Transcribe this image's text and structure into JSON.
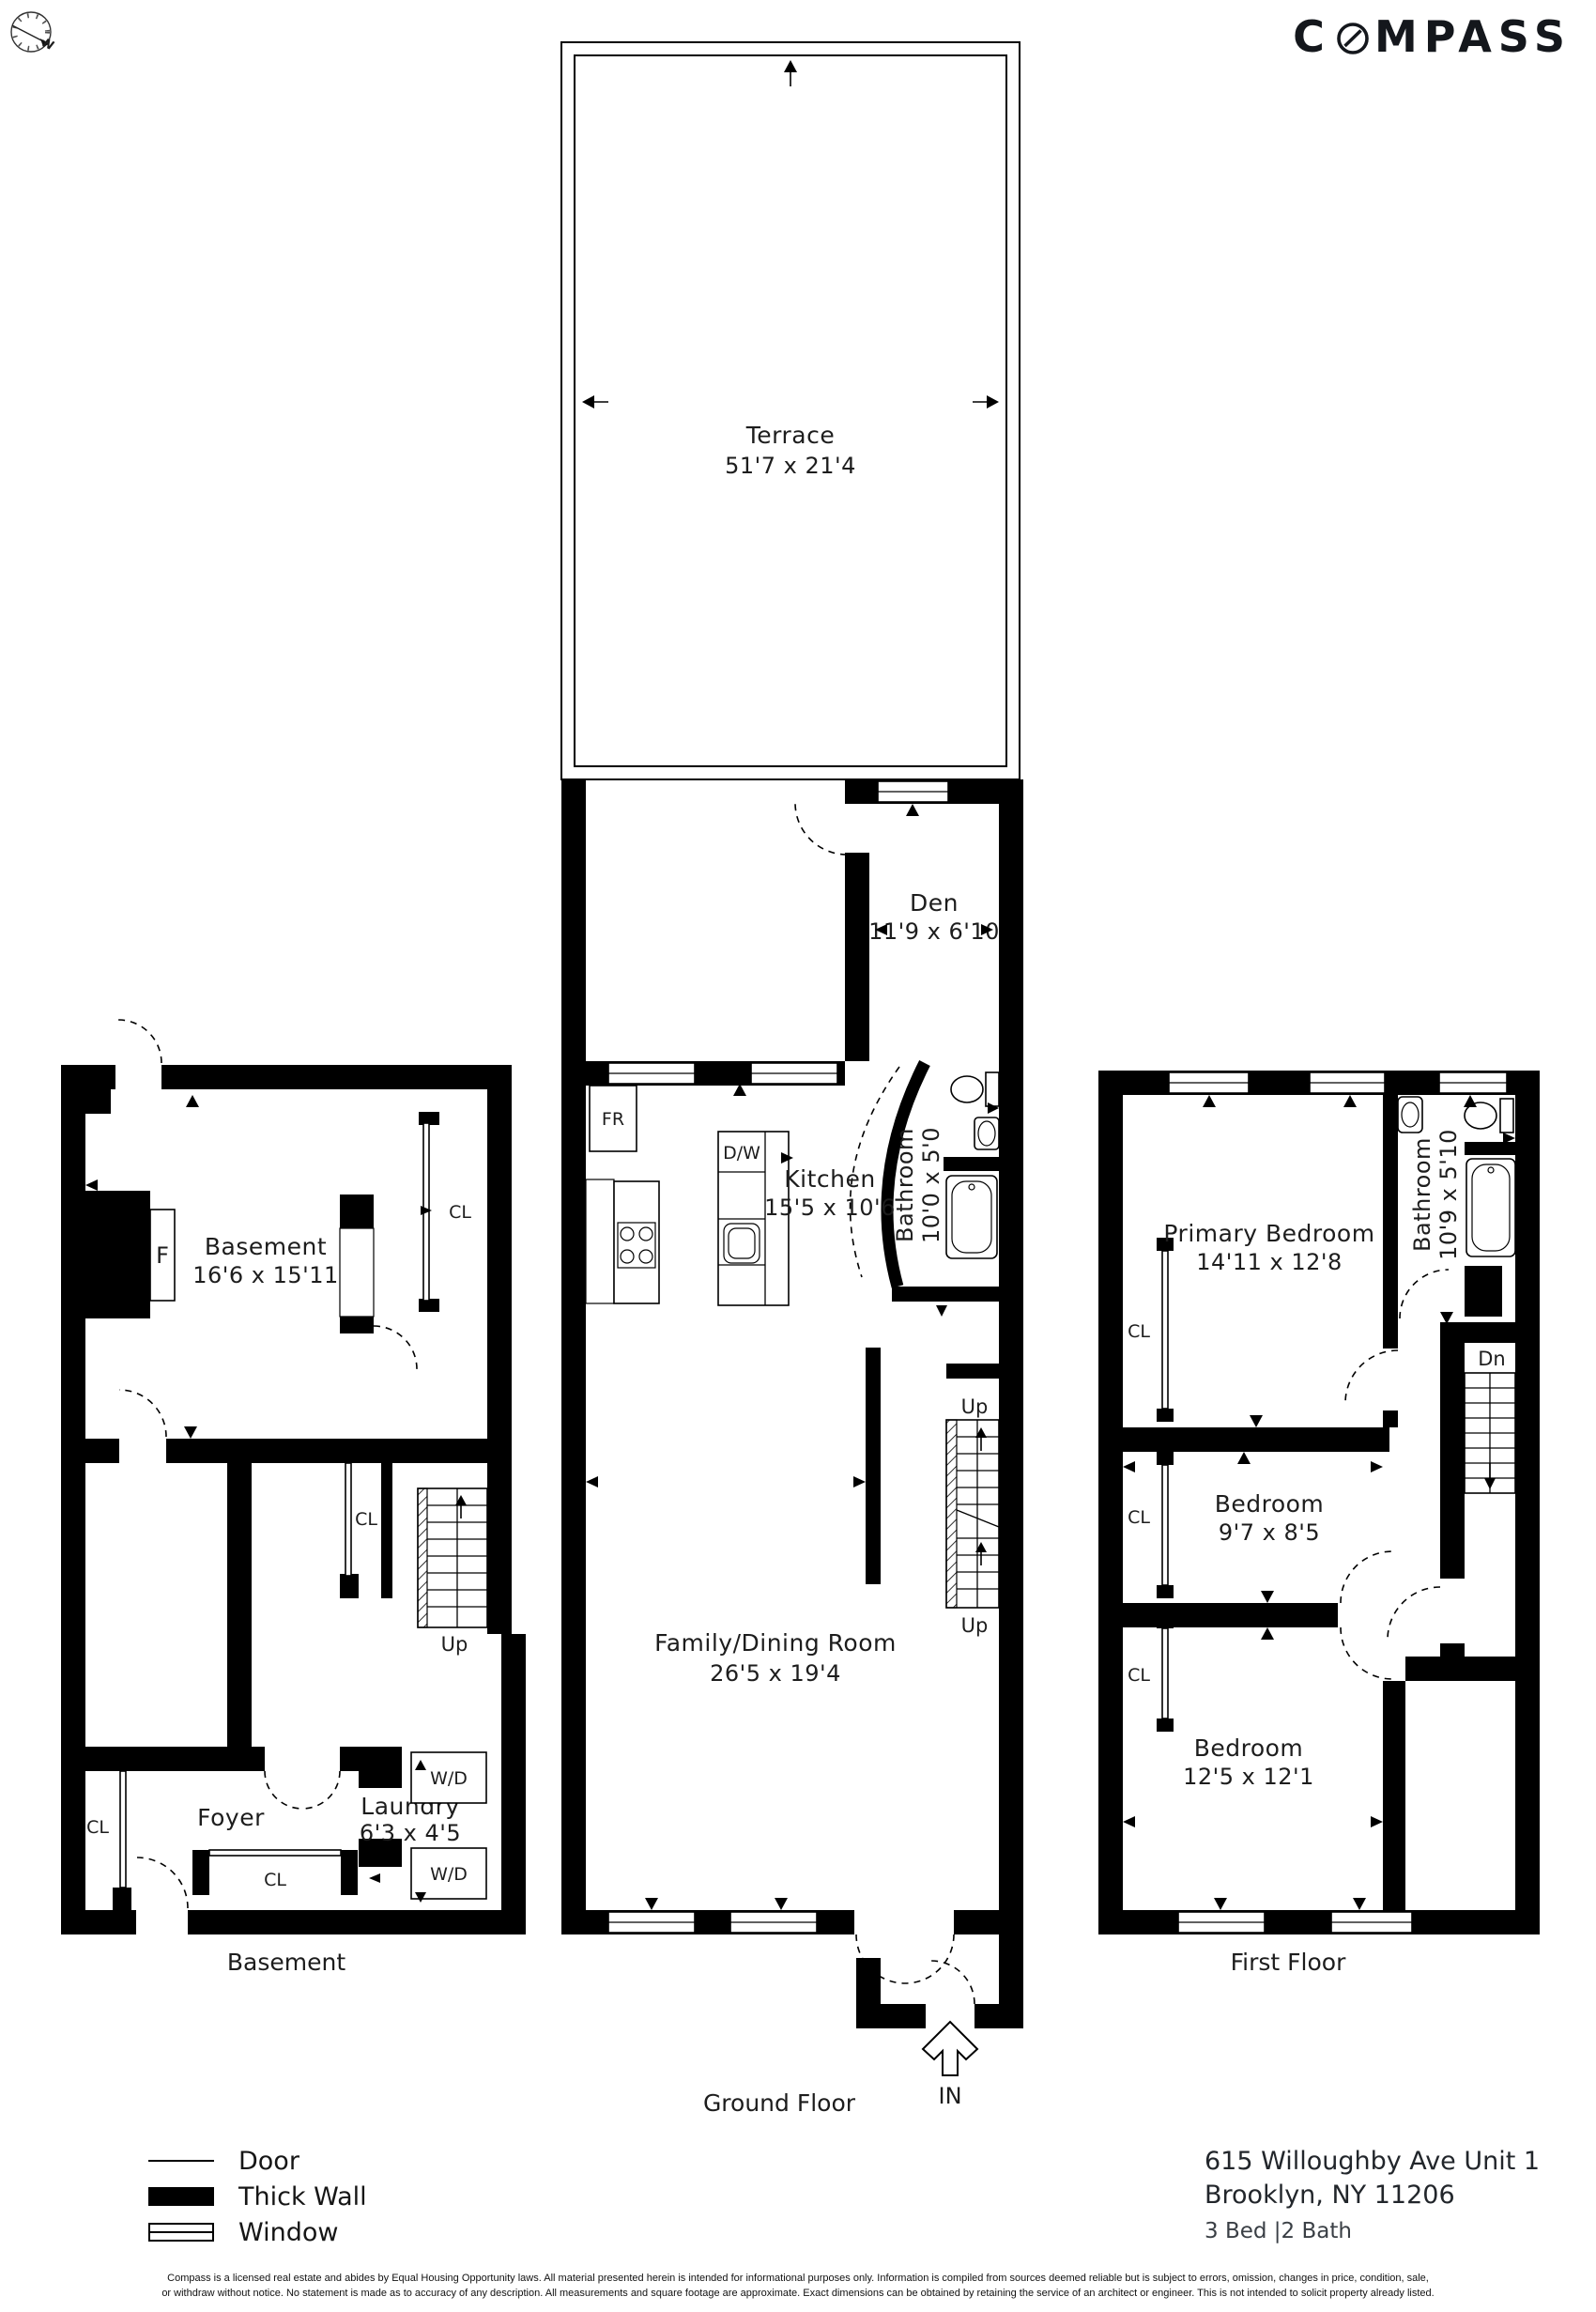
{
  "brand": {
    "logo_c": "C",
    "logo_rest": "MPASS",
    "north": "N"
  },
  "floors": {
    "basement": {
      "title": "Basement",
      "room": {
        "name": "Basement",
        "dims": "16'6 x 15'11"
      },
      "foyer": "Foyer",
      "laundry": {
        "name": "Laundry",
        "dims": "6'3 x 4'5"
      },
      "fireplace": "F",
      "closet_label": "CL",
      "wd_label": "W/D",
      "up": "Up"
    },
    "ground": {
      "title": "Ground Floor",
      "terrace": {
        "name": "Terrace",
        "dims": "51'7 x 21'4"
      },
      "den": {
        "name": "Den",
        "dims": "11'9 x 6'10"
      },
      "kitchen": {
        "name": "Kitchen",
        "dims": "15'5 x 10'6"
      },
      "bathroom": {
        "name": "Bathroom",
        "dims": "10'0 x 5'0"
      },
      "family": {
        "name": "Family/Dining Room",
        "dims": "26'5 x 19'4"
      },
      "fridge": "FR",
      "dishwasher": "D/W",
      "up": "Up",
      "entry": "IN"
    },
    "first": {
      "title": "First Floor",
      "primary": {
        "name": "Primary Bedroom",
        "dims": "14'11 x 12'8"
      },
      "bathroom": {
        "name": "Bathroom",
        "dims": "10'9 x 5'10"
      },
      "bedroom2": {
        "name": "Bedroom",
        "dims": "9'7 x 8'5"
      },
      "bedroom3": {
        "name": "Bedroom",
        "dims": "12'5 x 12'1"
      },
      "closet_label": "CL",
      "down": "Dn"
    }
  },
  "legend": {
    "door": "Door",
    "thick_wall": "Thick Wall",
    "window": "Window"
  },
  "property": {
    "address_line1": "615 Willoughby Ave Unit 1",
    "address_line2": "Brooklyn, NY 11206",
    "beds_baths": "3 Bed |2 Bath"
  },
  "disclaimer": {
    "line1": "Compass is a licensed real estate and abides by Equal Housing Opportunity laws. All material presented herein is intended for informational purposes only. Information is compiled from sources deemed reliable but is subject to errors, omission, changes in price, condition, sale,",
    "line2": "or withdraw without notice. No statement is made as to accuracy of any description. All measurements and square footage are approximate. Exact dimensions can be obtained by retaining the service of an architect or engineer. This is not intended to solicit property already listed."
  }
}
